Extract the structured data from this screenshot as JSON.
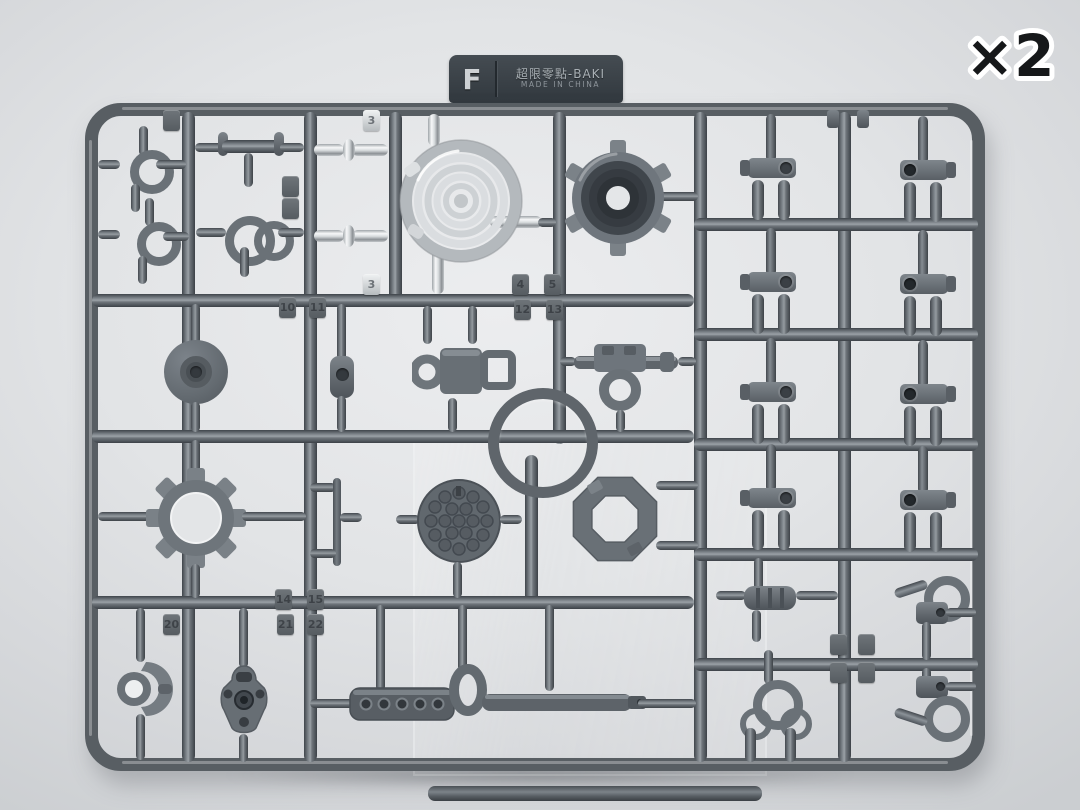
{
  "scene": {
    "description": "Injection-molded model kit parts runner (sprue) F in gray plastic with chrome-plated spring, photographed on a light gray background",
    "multiplier": "×2"
  },
  "label_tab": {
    "letter": "F",
    "series_name": "超限零點-BAKI",
    "origin_line": "MADE IN CHINA"
  },
  "gate_numbers_visible": [
    "3",
    "4",
    "5",
    "10",
    "11",
    "12",
    "13",
    "14",
    "15",
    "20",
    "21",
    "22"
  ],
  "gate_tags": [
    {
      "label": "3"
    },
    {
      "label": "3"
    },
    {
      "label": "4"
    },
    {
      "label": "5"
    },
    {
      "label": "10"
    },
    {
      "label": "11"
    },
    {
      "label": "12"
    },
    {
      "label": "13"
    },
    {
      "label": "14"
    },
    {
      "label": "15"
    },
    {
      "label": "20"
    },
    {
      "label": "21"
    },
    {
      "label": "22"
    },
    {
      "label": ""
    },
    {
      "label": ""
    },
    {
      "label": ""
    },
    {
      "label": ""
    },
    {
      "label": ""
    },
    {
      "label": ""
    },
    {
      "label": ""
    }
  ],
  "colors": {
    "background": "#e2e4e6",
    "runner_gray": "#5a6065",
    "runner_highlight": "#9aa1a6",
    "chrome_plating": "#e9ecee",
    "label_tab_bg": "#383f45",
    "multiplier_fill": "#16181a",
    "multiplier_outline": "#ffffff"
  }
}
